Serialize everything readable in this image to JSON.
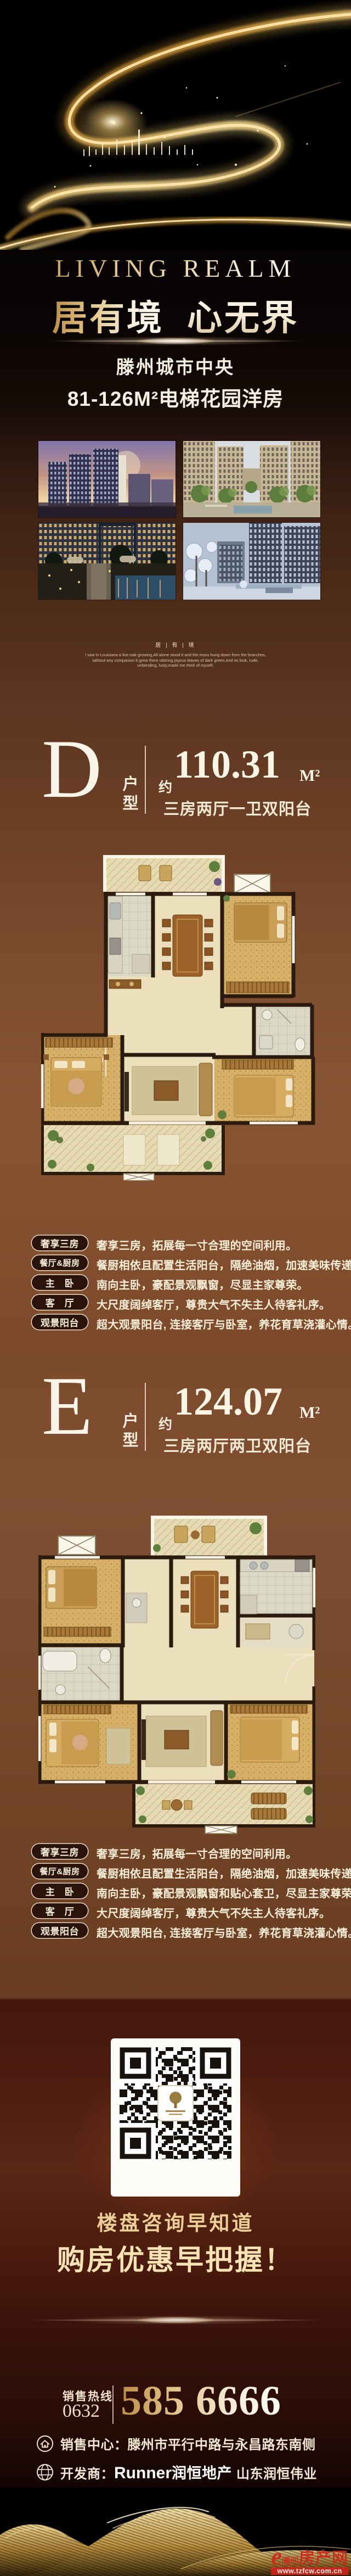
{
  "hero": {
    "tagline": "LIVING REALM",
    "slogan_gold": "居有境",
    "slogan_white": "心无界",
    "location": "滕州城市中央",
    "product": "81-126M²电梯花园洋房"
  },
  "poem": {
    "header": "居 | 有 | 境",
    "line1": "I saw in Louisiana a live-oak growing,All alone stood it and the moss hung down from the branches,",
    "line2": "without any companion it grew there uttering joyous leaves of dark green,And its look, rude,",
    "line3": "unbending, lusty,made me think of myself,"
  },
  "units": {
    "d": {
      "letter": "D",
      "type_label": "户型",
      "approx_label": "约",
      "area": "110.31",
      "area_unit": "M²",
      "layout": "三房两厅一卫双阳台",
      "features": [
        {
          "label": "奢享三房",
          "text": "奢享三房，拓展每一寸合理的空间利用。"
        },
        {
          "label": "餐厅&厨房",
          "text": "餐厨相依且配置生活阳台，隔绝油烟，加速美味传递。"
        },
        {
          "label": "主　卧",
          "text": "南向主卧，豪配景观飘窗，尽显主家尊荣。"
        },
        {
          "label": "客　厅",
          "text": "大尺度阔绰客厅，尊贵大气不失主人待客礼序。"
        },
        {
          "label": "观景阳台",
          "text": "超大观景阳台, 连接客厅与卧室，养花育草浇灌心情。"
        }
      ]
    },
    "e": {
      "letter": "E",
      "type_label": "户型",
      "approx_label": "约",
      "area": "124.07",
      "area_unit": "M²",
      "layout": "三房两厅两卫双阳台",
      "features": [
        {
          "label": "奢享三房",
          "text": "奢享三房，拓展每一寸合理的空间利用。"
        },
        {
          "label": "餐厅&厨房",
          "text": "餐厨相依且配置生活阳台，隔绝油烟，加速美味传递。"
        },
        {
          "label": "主　卧",
          "text": "南向主卧，豪配景观飘窗和贴心套卫，尽显主家尊荣。"
        },
        {
          "label": "客　厅",
          "text": "大尺度阔绰客厅，尊贵大气不失主人待客礼序。"
        },
        {
          "label": "观景阳台",
          "text": "超大观景阳台, 连接客厅与卧室，养花育草浇灌心情。"
        }
      ]
    }
  },
  "promo": {
    "line1": "楼盘咨询早知道",
    "line2": "购房优惠早把握！"
  },
  "contact": {
    "hotline_label": "销售热线",
    "area_code": "0632",
    "phone_number": "585 6666",
    "sales_center_label": "销售中心：",
    "sales_center_address": "滕州市平行中路与永昌路东南侧",
    "developer_label": "开发商：",
    "developer_brand": "Runner",
    "developer_cn": "润恒地产",
    "developer_company": "山东润恒伟业"
  },
  "watermark": {
    "site_initial": "e",
    "site_city": "滕州",
    "site_name": "房产网",
    "site_url": "www.tzfcw.com.cn"
  },
  "colors": {
    "gold_accent": "#d3a862",
    "cream_text": "#f6eed9",
    "brown_bg": "#7d4c2e",
    "maroon_bg": "#44180d",
    "watermark_red": "#d0241a"
  }
}
